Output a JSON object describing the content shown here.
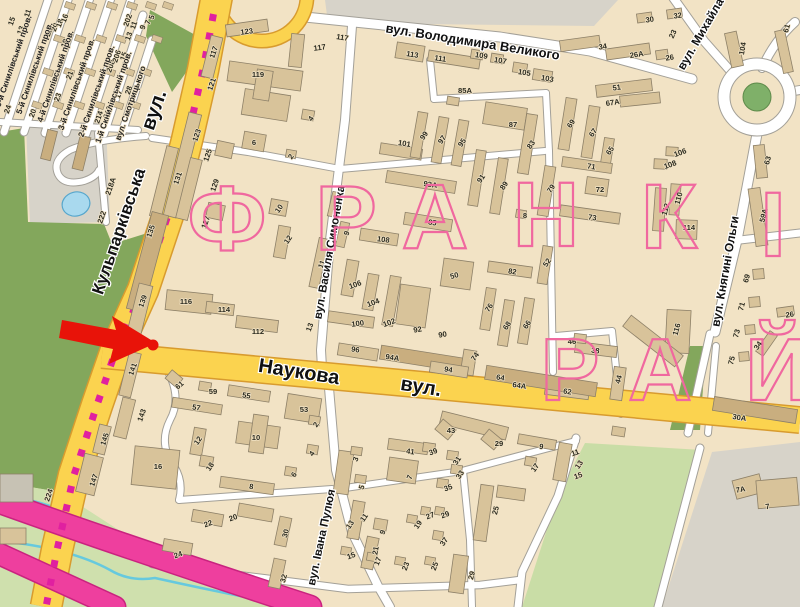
{
  "map_title": "Франківський район — фрагмент карти міста",
  "marker": {
    "type": "red-arrow-with-dot",
    "color": "#e81309"
  },
  "colors": {
    "land": "#f2e3c5",
    "building": "#d8c39a",
    "building_dark": "#c9ae7f",
    "building_gray": "#c7c2b4",
    "building_stroke": "#8d8068",
    "road_major": "#fbd34f",
    "road_major_casing": "#d89b2e",
    "road_minor": "#ffffff",
    "road_minor_casing": "#a3a098",
    "park": "#83a75c",
    "park_light": "#cfe0ad",
    "green_light2": "#c9dda6",
    "water": "#a9d9ee",
    "water_stroke": "#56a6cc",
    "stream": "#66c9de",
    "urban_gray": "#d7d3c9",
    "tram_dash": "#e020a0",
    "highway_pink": "#ee3f9e",
    "highway_pink_casing": "#c9237f",
    "roundabout_green": "#7fb069",
    "district_letters": "#f0689f",
    "marker_red": "#e81309"
  },
  "district": {
    "name_letters_row1": [
      {
        "t": "Ф",
        "x": 228,
        "y": 250,
        "s": 92
      },
      {
        "t": "Р",
        "x": 347,
        "y": 250,
        "s": 92
      },
      {
        "t": "А",
        "x": 436,
        "y": 248,
        "s": 92
      },
      {
        "t": "Н",
        "x": 547,
        "y": 246,
        "s": 92
      },
      {
        "t": "К",
        "x": 670,
        "y": 248,
        "s": 92
      },
      {
        "t": "І",
        "x": 774,
        "y": 256,
        "s": 92
      }
    ],
    "name_letters_row2": [
      {
        "t": "Р",
        "x": 571,
        "y": 400,
        "s": 88
      },
      {
        "t": "А",
        "x": 661,
        "y": 400,
        "s": 88
      },
      {
        "t": "Й",
        "x": 778,
        "y": 400,
        "s": 88
      }
    ]
  },
  "streets": [
    {
      "t": "вул. Володимира Великого",
      "x": 472,
      "y": 46,
      "r": 9,
      "s": 13
    },
    {
      "t": "вул. Михайла",
      "x": 704,
      "y": 36,
      "r": -60,
      "s": 12
    },
    {
      "t": "вул. Княгині Ольги",
      "x": 729,
      "y": 272,
      "r": -80,
      "s": 12
    },
    {
      "t": "Кульпарківська",
      "x": 124,
      "y": 233,
      "r": -71,
      "s": 17
    },
    {
      "t": "вул.",
      "x": 160,
      "y": 112,
      "r": -71,
      "s": 20
    },
    {
      "t": "Наукова",
      "x": 298,
      "y": 378,
      "r": 9,
      "s": 20
    },
    {
      "t": "вул.",
      "x": 420,
      "y": 393,
      "r": 9,
      "s": 20
    },
    {
      "t": "вул. Василя Симоненка",
      "x": 333,
      "y": 253,
      "r": -80,
      "s": 11.5
    },
    {
      "t": "вул. Івана Пулюя",
      "x": 325,
      "y": 538,
      "r": -78,
      "s": 11.5
    }
  ],
  "lanes": [
    {
      "t": "6-й Скнилівський пров.",
      "x": 16,
      "y": 62
    },
    {
      "t": "5-й Скнилівський пров.",
      "x": 37,
      "y": 69
    },
    {
      "t": "4-й Скнилівський пров.",
      "x": 58,
      "y": 77
    },
    {
      "t": "3-й Скнилівський пров.",
      "x": 79,
      "y": 85
    },
    {
      "t": "2-й Скнилівський пров.",
      "x": 99,
      "y": 92
    },
    {
      "t": "1-й Скнилівський пров.",
      "x": 116,
      "y": 98
    },
    {
      "t": "вул. Смотрицького",
      "x": 133,
      "y": 104
    }
  ],
  "numbers": [
    [
      "15",
      14,
      22,
      -71
    ],
    [
      "13",
      23,
      31,
      -71
    ],
    [
      "11",
      30,
      14,
      -71
    ],
    [
      "22",
      51,
      33,
      -71
    ],
    [
      "20",
      57,
      28,
      -71
    ],
    [
      "18",
      62,
      24,
      -71
    ],
    [
      "16",
      67,
      19,
      -71
    ],
    [
      "19",
      67,
      44,
      -71
    ],
    [
      "21",
      72,
      76,
      -71
    ],
    [
      "23",
      60,
      98,
      -71
    ],
    [
      "24",
      10,
      110,
      -71
    ],
    [
      "20",
      35,
      114,
      -71
    ],
    [
      "17",
      121,
      95,
      -71
    ],
    [
      "15",
      126,
      57,
      -71
    ],
    [
      "13",
      131,
      37,
      -71
    ],
    [
      "11",
      136,
      26,
      -71
    ],
    [
      "9",
      145,
      28,
      -71
    ],
    [
      "7",
      150,
      23,
      -71
    ],
    [
      "5",
      154,
      18,
      -71
    ],
    [
      "208",
      113,
      67,
      -71
    ],
    [
      "206",
      119,
      57,
      -71
    ],
    [
      "214",
      101,
      118,
      -71
    ],
    [
      "212",
      110,
      113,
      -71
    ],
    [
      "202",
      130,
      21,
      -71
    ],
    [
      "28",
      131,
      91,
      -71
    ],
    [
      "222",
      104,
      218,
      -71
    ],
    [
      "218А",
      113,
      187,
      -71
    ],
    [
      "123",
      199,
      136,
      -71
    ],
    [
      "125",
      210,
      156,
      -71
    ],
    [
      "127",
      208,
      223,
      -71
    ],
    [
      "129",
      217,
      186,
      -71
    ],
    [
      "131",
      180,
      179,
      -71
    ],
    [
      "135",
      153,
      232,
      -71
    ],
    [
      "139",
      145,
      302,
      -71
    ],
    [
      "121",
      214,
      85,
      -71
    ],
    [
      "117",
      216,
      53,
      -71
    ],
    [
      "141",
      135,
      370,
      -71
    ],
    [
      "143",
      144,
      416,
      -71
    ],
    [
      "145",
      107,
      440,
      -71
    ],
    [
      "147",
      96,
      481,
      -71
    ],
    [
      "224",
      51,
      496,
      -71
    ],
    [
      "123",
      247,
      34,
      -8
    ],
    [
      "117",
      320,
      50,
      -8
    ],
    [
      "119",
      258,
      77,
      0
    ],
    [
      "117",
      342,
      40,
      9
    ],
    [
      "113",
      412,
      57,
      9
    ],
    [
      "111",
      440,
      61,
      9
    ],
    [
      "109",
      481,
      58,
      9
    ],
    [
      "107",
      500,
      63,
      9
    ],
    [
      "105",
      524,
      75,
      9
    ],
    [
      "103",
      547,
      81,
      9
    ],
    [
      "85А",
      465,
      93,
      0
    ],
    [
      "87",
      513,
      127,
      0
    ],
    [
      "101",
      404,
      146,
      9
    ],
    [
      "99",
      426,
      137,
      -55
    ],
    [
      "97",
      444,
      141,
      -55
    ],
    [
      "95",
      464,
      144,
      -55
    ],
    [
      "93А",
      430,
      187,
      9
    ],
    [
      "91",
      483,
      180,
      -55
    ],
    [
      "89",
      506,
      187,
      -55
    ],
    [
      "83",
      533,
      146,
      -55
    ],
    [
      "85",
      432,
      225,
      9
    ],
    [
      "79",
      553,
      190,
      -55
    ],
    [
      "8",
      525,
      218,
      0
    ],
    [
      "73",
      592,
      220,
      8
    ],
    [
      "71",
      591,
      169,
      8
    ],
    [
      "72",
      600,
      192,
      0
    ],
    [
      "69",
      573,
      125,
      -55
    ],
    [
      "67",
      595,
      134,
      -55
    ],
    [
      "67А",
      613,
      105,
      -8
    ],
    [
      "65",
      612,
      152,
      -55
    ],
    [
      "51",
      617,
      90,
      -8
    ],
    [
      "34",
      603,
      49,
      -8
    ],
    [
      "26А",
      637,
      57,
      -8
    ],
    [
      "26",
      670,
      60,
      -8
    ],
    [
      "23",
      675,
      35,
      -65
    ],
    [
      "32",
      678,
      18,
      -8
    ],
    [
      "30",
      650,
      22,
      -8
    ],
    [
      "104",
      745,
      49,
      -80
    ],
    [
      "61",
      789,
      29,
      -75
    ],
    [
      "4",
      313,
      120,
      -55
    ],
    [
      "6",
      254,
      145,
      0
    ],
    [
      "2",
      293,
      158,
      -55
    ],
    [
      "10",
      281,
      210,
      -55
    ],
    [
      "12",
      290,
      241,
      -55
    ],
    [
      "7",
      341,
      205,
      -70
    ],
    [
      "9",
      349,
      234,
      -70
    ],
    [
      "108",
      383,
      242,
      8
    ],
    [
      "11",
      324,
      265,
      -70
    ],
    [
      "106",
      356,
      287,
      -20
    ],
    [
      "104",
      374,
      305,
      -20
    ],
    [
      "100",
      358,
      326,
      -8
    ],
    [
      "102",
      390,
      325,
      -20
    ],
    [
      "92",
      418,
      332,
      -10
    ],
    [
      "90",
      443,
      337,
      -10
    ],
    [
      "50",
      455,
      278,
      -15
    ],
    [
      "82",
      512,
      274,
      8
    ],
    [
      "76",
      491,
      309,
      -55
    ],
    [
      "68",
      509,
      327,
      -55
    ],
    [
      "66",
      529,
      326,
      -55
    ],
    [
      "52",
      549,
      264,
      -55
    ],
    [
      "13",
      312,
      328,
      -70
    ],
    [
      "108",
      671,
      167,
      -20
    ],
    [
      "106",
      681,
      155,
      -20
    ],
    [
      "110",
      681,
      199,
      -75
    ],
    [
      "112",
      668,
      210,
      -75
    ],
    [
      "114",
      689,
      230,
      0
    ],
    [
      "116",
      679,
      330,
      -75
    ],
    [
      "63",
      770,
      161,
      -75
    ],
    [
      "59А",
      766,
      216,
      -75
    ],
    [
      "69",
      749,
      279,
      -75
    ],
    [
      "71",
      744,
      307,
      -75
    ],
    [
      "73",
      739,
      334,
      -75
    ],
    [
      "75",
      734,
      361,
      -75
    ],
    [
      "34",
      760,
      347,
      -55
    ],
    [
      "26",
      790,
      317,
      -8
    ],
    [
      "112",
      258,
      334,
      0
    ],
    [
      "114",
      224,
      312,
      0
    ],
    [
      "116",
      186,
      304,
      0
    ],
    [
      "96",
      355,
      352,
      9
    ],
    [
      "94А",
      392,
      360,
      9
    ],
    [
      "94",
      448,
      372,
      9
    ],
    [
      "74",
      477,
      358,
      -55
    ],
    [
      "64",
      500,
      380,
      9
    ],
    [
      "64А",
      519,
      388,
      9
    ],
    [
      "62",
      567,
      394,
      9
    ],
    [
      "46",
      572,
      344,
      0
    ],
    [
      "38",
      595,
      353,
      7
    ],
    [
      "44",
      621,
      380,
      -75
    ],
    [
      "30А",
      739,
      420,
      9
    ],
    [
      "61",
      181,
      387,
      -40
    ],
    [
      "59",
      213,
      394,
      0
    ],
    [
      "57",
      196,
      410,
      9
    ],
    [
      "55",
      246,
      398,
      9
    ],
    [
      "53",
      304,
      412,
      0
    ],
    [
      "2",
      318,
      426,
      -55
    ],
    [
      "4",
      314,
      455,
      -55
    ],
    [
      "6",
      296,
      476,
      -55
    ],
    [
      "8",
      251,
      489,
      8
    ],
    [
      "10",
      256,
      440,
      0
    ],
    [
      "12",
      200,
      442,
      -55
    ],
    [
      "16",
      158,
      469,
      0
    ],
    [
      "18",
      212,
      468,
      -55
    ],
    [
      "20",
      234,
      520,
      -20
    ],
    [
      "22",
      209,
      526,
      -20
    ],
    [
      "24",
      179,
      557,
      -20
    ],
    [
      "3",
      358,
      460,
      -70
    ],
    [
      "5",
      364,
      488,
      -70
    ],
    [
      "41",
      410,
      454,
      8
    ],
    [
      "39",
      434,
      454,
      -20
    ],
    [
      "31",
      459,
      462,
      -55
    ],
    [
      "33",
      462,
      476,
      -55
    ],
    [
      "35",
      449,
      490,
      -20
    ],
    [
      "7",
      412,
      478,
      -70
    ],
    [
      "43",
      451,
      433,
      0
    ],
    [
      "29",
      499,
      446,
      0
    ],
    [
      "9",
      541,
      449,
      8
    ],
    [
      "11",
      576,
      455,
      -20
    ],
    [
      "13",
      581,
      466,
      -55
    ],
    [
      "15",
      579,
      478,
      -20
    ],
    [
      "17",
      537,
      469,
      -55
    ],
    [
      "25",
      498,
      511,
      -75
    ],
    [
      "29",
      474,
      576,
      -75
    ],
    [
      "13",
      352,
      526,
      -55
    ],
    [
      "11",
      366,
      519,
      -55
    ],
    [
      "9",
      385,
      533,
      -70
    ],
    [
      "19",
      420,
      526,
      -55
    ],
    [
      "27",
      431,
      518,
      -20
    ],
    [
      "29",
      446,
      517,
      -20
    ],
    [
      "37",
      446,
      543,
      -55
    ],
    [
      "21",
      378,
      551,
      -80
    ],
    [
      "15",
      352,
      558,
      -20
    ],
    [
      "17",
      380,
      562,
      -70
    ],
    [
      "23",
      408,
      567,
      -70
    ],
    [
      "25",
      437,
      567,
      -70
    ],
    [
      "30",
      288,
      534,
      -75
    ],
    [
      "32",
      286,
      579,
      -75
    ],
    [
      "7А",
      741,
      492,
      -10
    ],
    [
      "7",
      768,
      509,
      -10
    ]
  ]
}
